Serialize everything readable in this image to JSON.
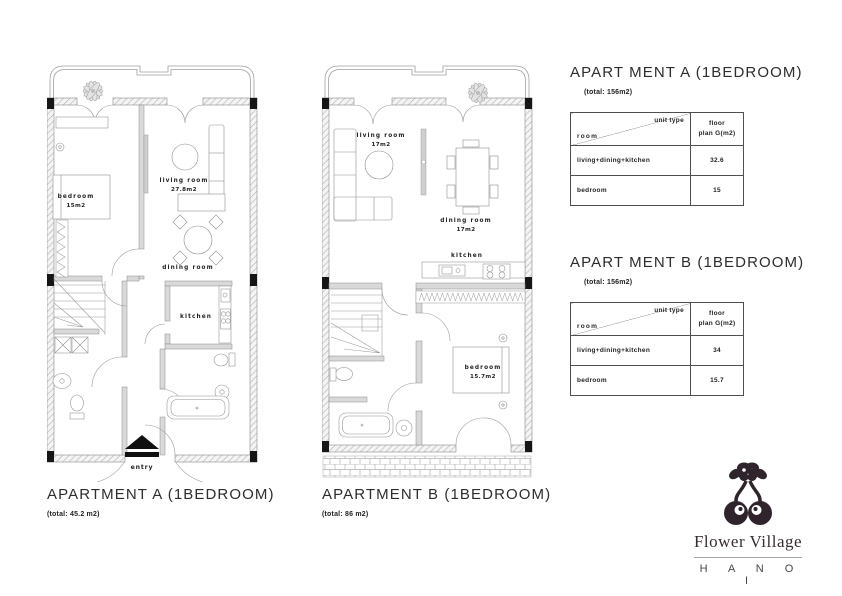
{
  "plans": {
    "a": {
      "caption": "APARTMENT A (1BEDROOM)",
      "caption_total": "(total: 45.2 m2)",
      "labels": {
        "bedroom": "bedroom",
        "bedroom_area": "15m2",
        "living": "living room",
        "living_area": "27.8m2",
        "dining": "dining room",
        "kitchen": "kitchen",
        "entry": "entry"
      }
    },
    "b": {
      "caption": "APARTMENT B (1BEDROOM)",
      "caption_total": "(total: 86 m2)",
      "labels": {
        "living": "living room",
        "living_area": "17m2",
        "dining": "dining room",
        "dining_area": "17m2",
        "kitchen": "kitchen",
        "bedroom": "bedroom",
        "bedroom_area": "15.7m2"
      }
    }
  },
  "panel": {
    "a": {
      "title": "APART MENT A (1BEDROOM)",
      "total": "(total: 156m2)",
      "table": {
        "unit_type": "unit type",
        "room": "room",
        "floor_line1": "floor",
        "floor_line2": "plan G(m2)",
        "rows": [
          {
            "room": "living+dining+kitchen",
            "area": "32.6"
          },
          {
            "room": "bedroom",
            "area": "15"
          }
        ]
      }
    },
    "b": {
      "title": "APART MENT B (1BEDROOM)",
      "total": "(total: 156m2)",
      "table": {
        "unit_type": "unit type",
        "room": "room",
        "floor_line1": "floor",
        "floor_line2": "plan G(m2)",
        "rows": [
          {
            "room": "living+dining+kitchen",
            "area": "34"
          },
          {
            "room": "bedroom",
            "area": "15.7"
          }
        ]
      }
    }
  },
  "logo": {
    "brand": "Flower Village",
    "city": "H A N O I"
  },
  "colors": {
    "line": "#8f8f8f",
    "text": "#1f1f1f",
    "black": "#141414",
    "logo": "#2f242b"
  }
}
